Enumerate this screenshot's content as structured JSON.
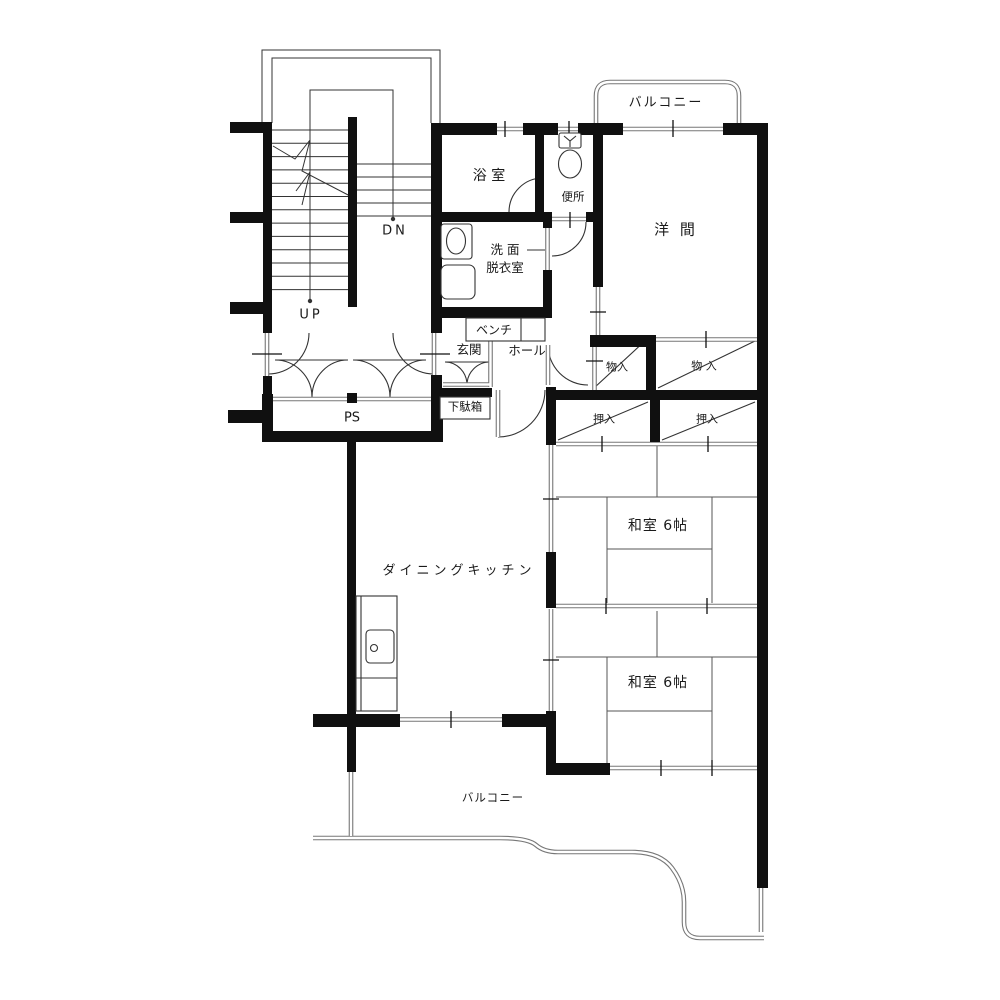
{
  "plan_type": "apartment-floor-plan",
  "colors": {
    "wall": "#101010",
    "thin_line": "#333333",
    "double_line": "#777777",
    "text": "#1a1a1a"
  },
  "labels": {
    "balcony_top": "バルコニー",
    "bath": "浴 室",
    "toilet": "便所",
    "western_room": "洋 間",
    "washroom_line1": "洗 面",
    "washroom_line2": "脱衣室",
    "bench": "ベンチ",
    "entrance": "玄関",
    "hall": "ホール",
    "storage1": "物入",
    "storage2": "物 入",
    "closet1": "押入",
    "closet2": "押入",
    "shoe_cabinet": "下駄箱",
    "pipe_shaft": "PS",
    "dining_kitchen": "ダイニングキッチン",
    "japanese_room1": "和室 6帖",
    "japanese_room2": "和室 6帖",
    "balcony_bottom": "バルコニー",
    "stairs_up": "UP",
    "stairs_down": "DN"
  }
}
